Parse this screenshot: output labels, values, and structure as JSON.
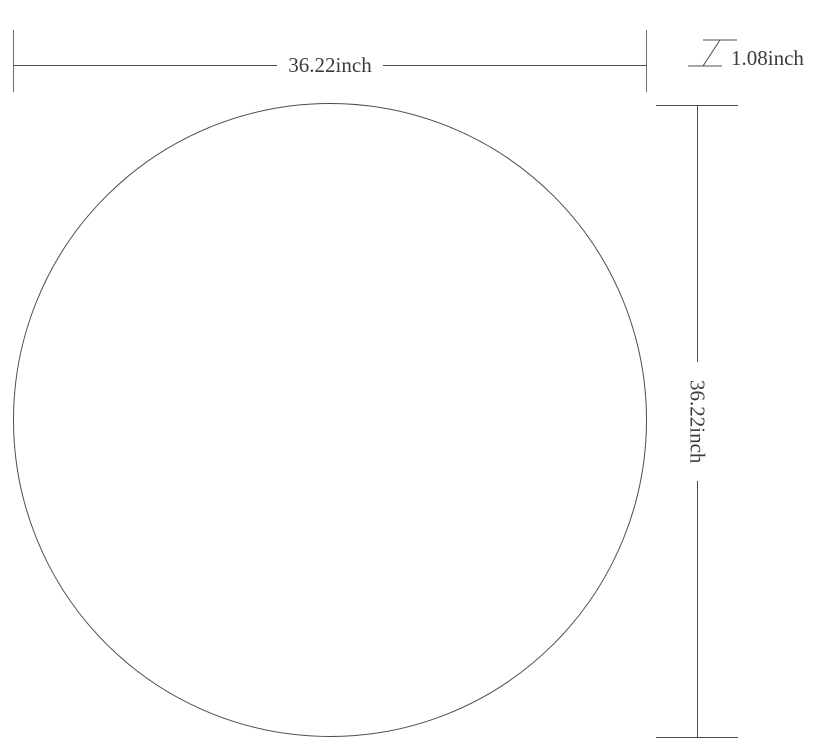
{
  "drawing": {
    "type": "dimension-diagram",
    "shape": "circle",
    "unit": "inch",
    "colors": {
      "background": "#ffffff",
      "line": "#4d4d4d",
      "tick": "#6e6e6e",
      "text": "#3c3c3c"
    },
    "width_dim": {
      "label": "36.22inch",
      "value": 36.22,
      "unit": "inch"
    },
    "height_dim": {
      "label": "36.22inch",
      "value": 36.22,
      "unit": "inch"
    },
    "thickness_dim": {
      "label": "1.08inch",
      "value": 1.08,
      "unit": "inch"
    }
  }
}
